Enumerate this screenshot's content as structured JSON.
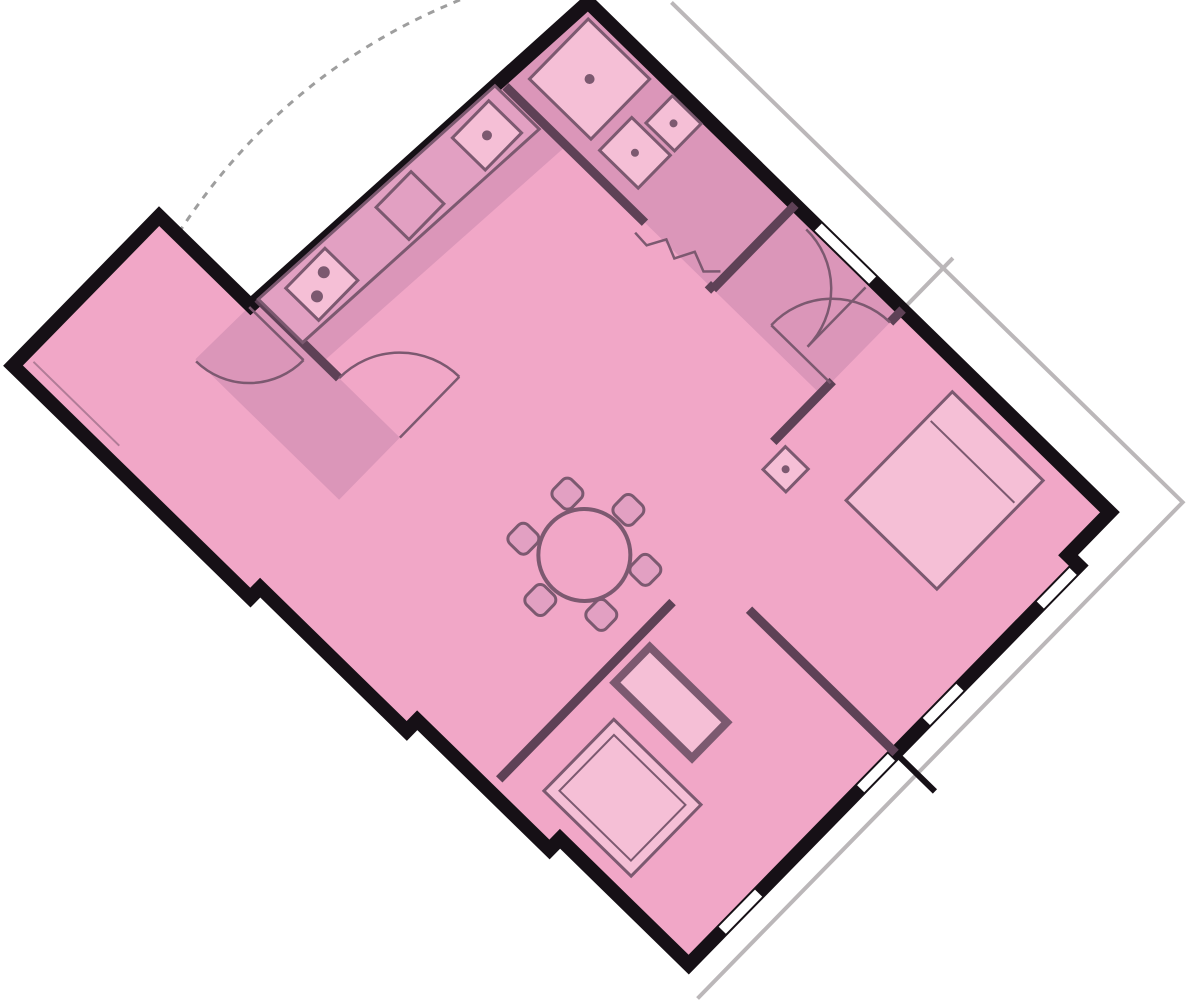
{
  "page": {
    "background_color": "#ffffff",
    "description": "apartment floor plan, rotated, highlighted pink"
  },
  "colors": {
    "background": "#ffffff",
    "floor": "#F1A7C7",
    "floor_shaded": "#DB96B9",
    "wall": "#161016",
    "wall_interior": "#5E4156",
    "furniture_fill": "#E2A0C2",
    "furniture_light": "#F5BFD6",
    "furniture_outline": "#7C5970",
    "balcony_line": "#BBB7B9",
    "dashed_line": "#9E9E9E",
    "window_gap": "#FFFFFF"
  },
  "floor_plan": {
    "type": "apartment-floor-plan",
    "rotation_deg": -45.7,
    "wall_thickness_px": 14,
    "rooms": [
      {
        "id": "bathroom"
      },
      {
        "id": "hallway"
      },
      {
        "id": "kitchen"
      },
      {
        "id": "living-dining-room"
      },
      {
        "id": "bedroom"
      },
      {
        "id": "second-room"
      },
      {
        "id": "corridor"
      },
      {
        "id": "vestibule"
      },
      {
        "id": "balcony"
      }
    ],
    "furniture": [
      {
        "id": "dining-table",
        "seats": 6
      },
      {
        "id": "double-bed"
      },
      {
        "id": "nightstand"
      },
      {
        "id": "wardrobe"
      },
      {
        "id": "wardrobe-2"
      },
      {
        "id": "kitchen-counter"
      },
      {
        "id": "kitchen-sink"
      },
      {
        "id": "stove"
      },
      {
        "id": "shower"
      },
      {
        "id": "toilet"
      },
      {
        "id": "washbasin"
      }
    ],
    "features": [
      {
        "id": "windows",
        "count": 4
      },
      {
        "id": "door-swing-arcs",
        "count": 4
      },
      {
        "id": "folding-door",
        "count": 1
      },
      {
        "id": "balcony-railing-line",
        "count": 1
      },
      {
        "id": "balcony-divider-wall",
        "count": 1
      },
      {
        "id": "dashed-projection-arc",
        "count": 1
      },
      {
        "id": "railing-tick",
        "count": 1
      }
    ]
  }
}
